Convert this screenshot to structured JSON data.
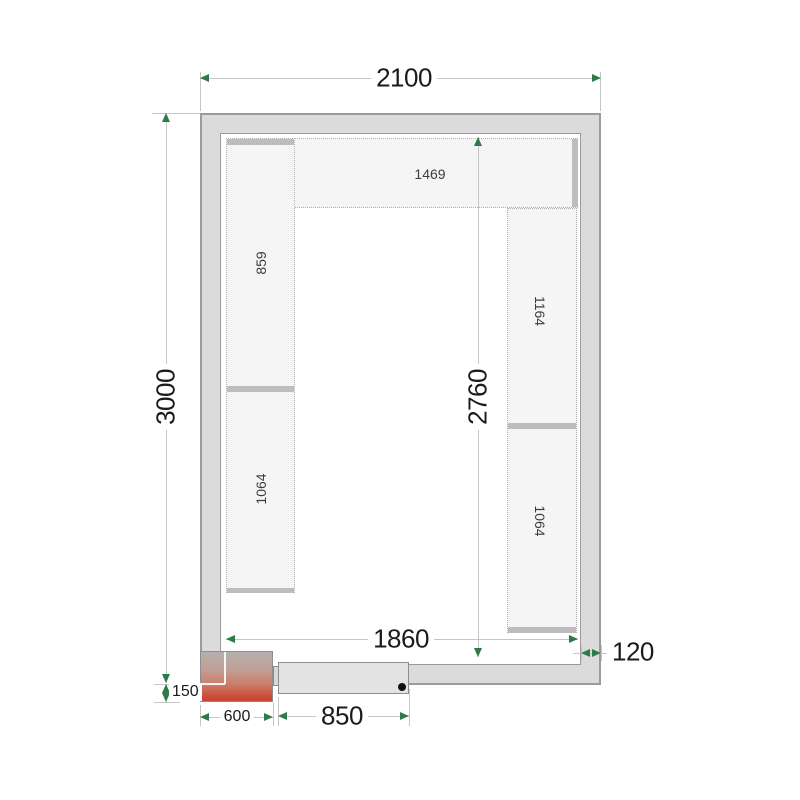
{
  "plan": {
    "dimensions": {
      "outer_width": "2100",
      "outer_height": "3000",
      "inner_height": "2760",
      "inner_width": "1860",
      "wall_thickness": "120",
      "corner_offset": "150",
      "corner_unit_width": "600",
      "door_width": "850"
    },
    "shelves": {
      "top": "1469",
      "left_upper": "859",
      "left_lower": "1064",
      "right_upper": "1164",
      "right_lower": "1064"
    },
    "colors": {
      "wall_fill": "#dbdbdb",
      "wall_edge": "#9b9b9b",
      "shelf_fill": "#f5f5f6",
      "shelf_strip": "#bdbdbd",
      "dim_line": "#c6c6c6",
      "arrow_green": "#2e7b4a",
      "door_fill": "#e3e3e3",
      "heater_red": "#cb4b37"
    }
  }
}
